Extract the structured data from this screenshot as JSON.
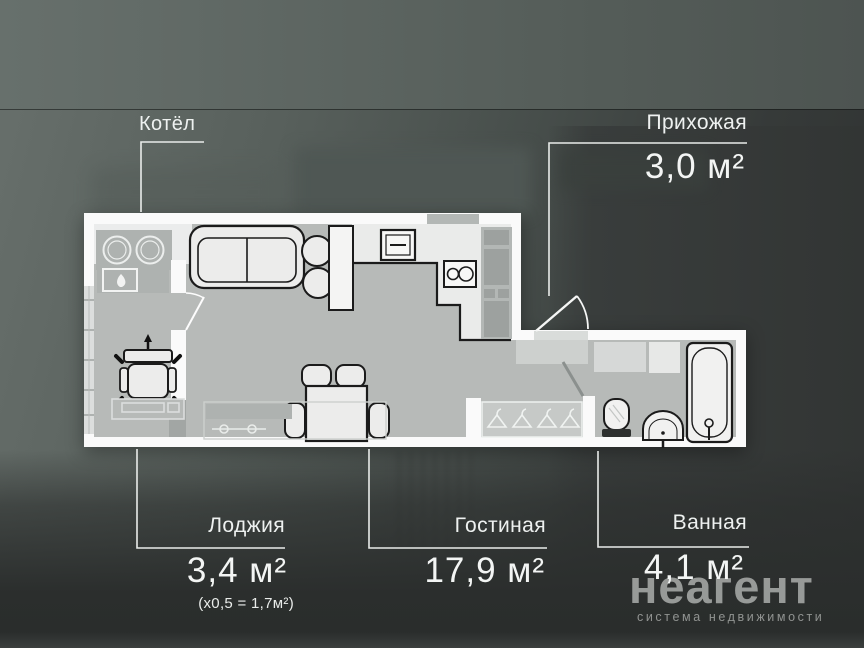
{
  "rooms": [
    {
      "key": "kotel",
      "label": "Котёл"
    },
    {
      "key": "prihozhaya",
      "label": "Прихожая",
      "area": "3,0 м²"
    },
    {
      "key": "lodzhiya",
      "label": "Лоджия",
      "area": "3,4 м²",
      "note": "(х0,5 = 1,7м²)"
    },
    {
      "key": "gostinaya",
      "label": "Гостиная",
      "area": "17,9 м²"
    },
    {
      "key": "vannaya",
      "label": "Ванная",
      "area": "4,1 м²"
    }
  ],
  "watermark": {
    "brand": "неагент",
    "tagline": "система недвижимости"
  },
  "colors": {
    "wall": "#fafafa",
    "floor": "#b7bab8",
    "kitchen_floor": "#eaebea",
    "furniture_outline": "#1b1b1b",
    "label_text": "#eef1f0",
    "leader_line": "#e9ecea",
    "watermark_grey": "#b0b2b0",
    "background_dark": "#323534"
  }
}
